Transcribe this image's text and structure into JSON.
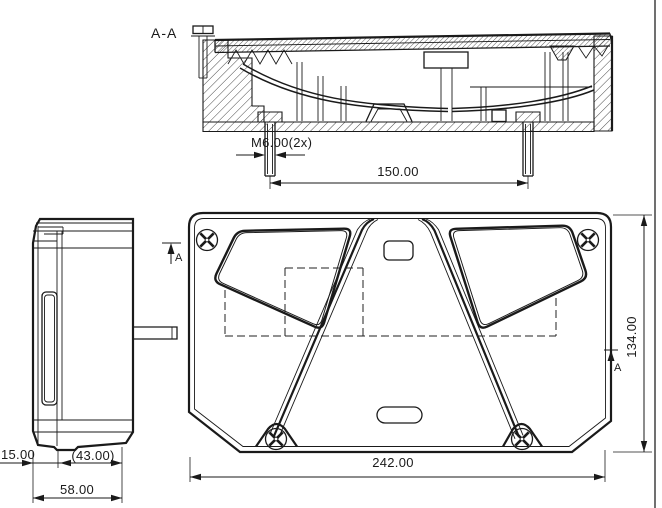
{
  "labels": {
    "section": "A-A",
    "cut_arrow_top": "A",
    "cut_arrow_right": "A"
  },
  "dimensions": {
    "thread": "M6.00(2x)",
    "stud_spacing": "150.00",
    "lens_depth": "15.00",
    "body_depth_ref": "(43.00)",
    "total_depth": "58.00",
    "total_width": "242.00",
    "total_height": "134.00"
  },
  "colors": {
    "line": "#1a1a1a",
    "background": "#ffffff"
  }
}
